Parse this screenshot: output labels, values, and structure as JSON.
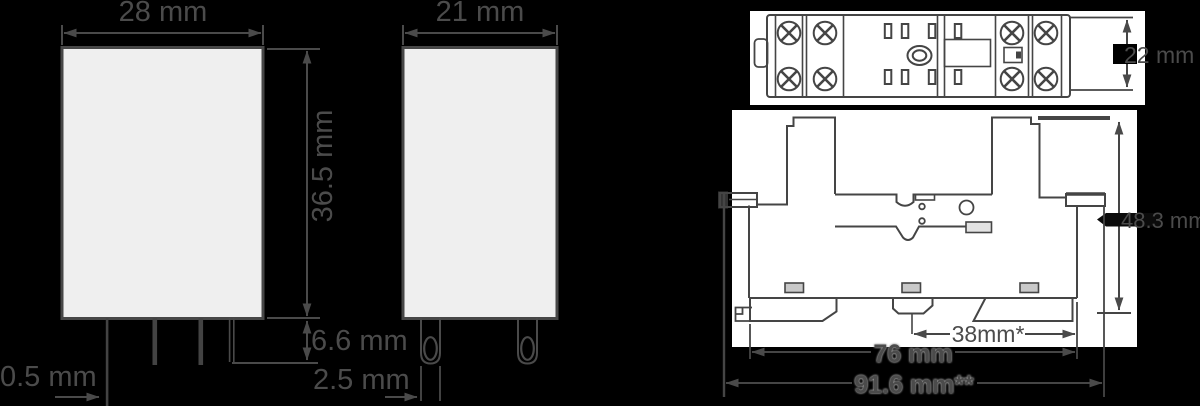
{
  "drawing": {
    "relay_front_view": {
      "width_label": "28 mm",
      "height_label": "36.5 mm",
      "pin_length_label": "6.6 mm",
      "pin_thickness_label": "0.5 mm"
    },
    "relay_side_view": {
      "width_label": "21 mm",
      "pin_thickness_label": "2.5 mm"
    },
    "socket_top_view": {
      "depth_label": "22 mm"
    },
    "socket_front_view": {
      "height_label": "48.3 mm",
      "rail_hole_spacing_label": "38mm*",
      "body_width_label": "76 mm",
      "overall_width_label": "91.6 mm**"
    }
  }
}
